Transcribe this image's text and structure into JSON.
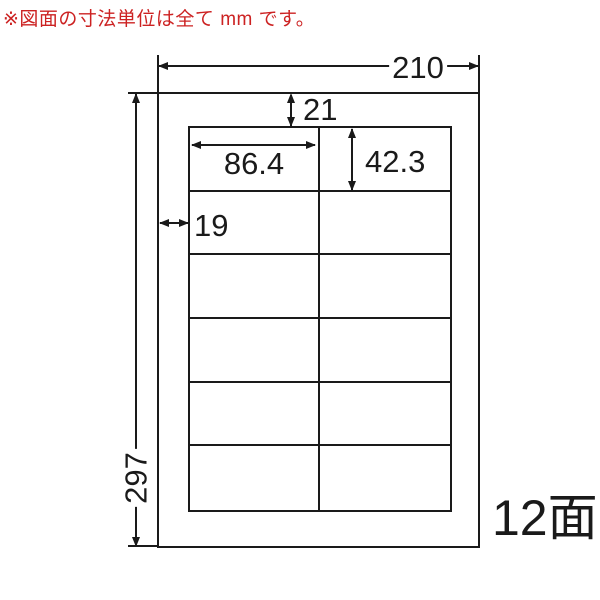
{
  "note": {
    "text": "※図面の寸法単位は全て mm です。"
  },
  "sheet": {
    "width_mm": "210",
    "height_mm": "297",
    "top_margin_mm": "21",
    "left_margin_mm": "19",
    "label_width_mm": "86.4",
    "label_height_mm": "42.3",
    "count_label": "12面",
    "rows": 6,
    "columns": 2,
    "total_labels": 12
  },
  "colors": {
    "line": "#1a1a1a",
    "note_text": "#cc2222",
    "background": "#ffffff"
  }
}
